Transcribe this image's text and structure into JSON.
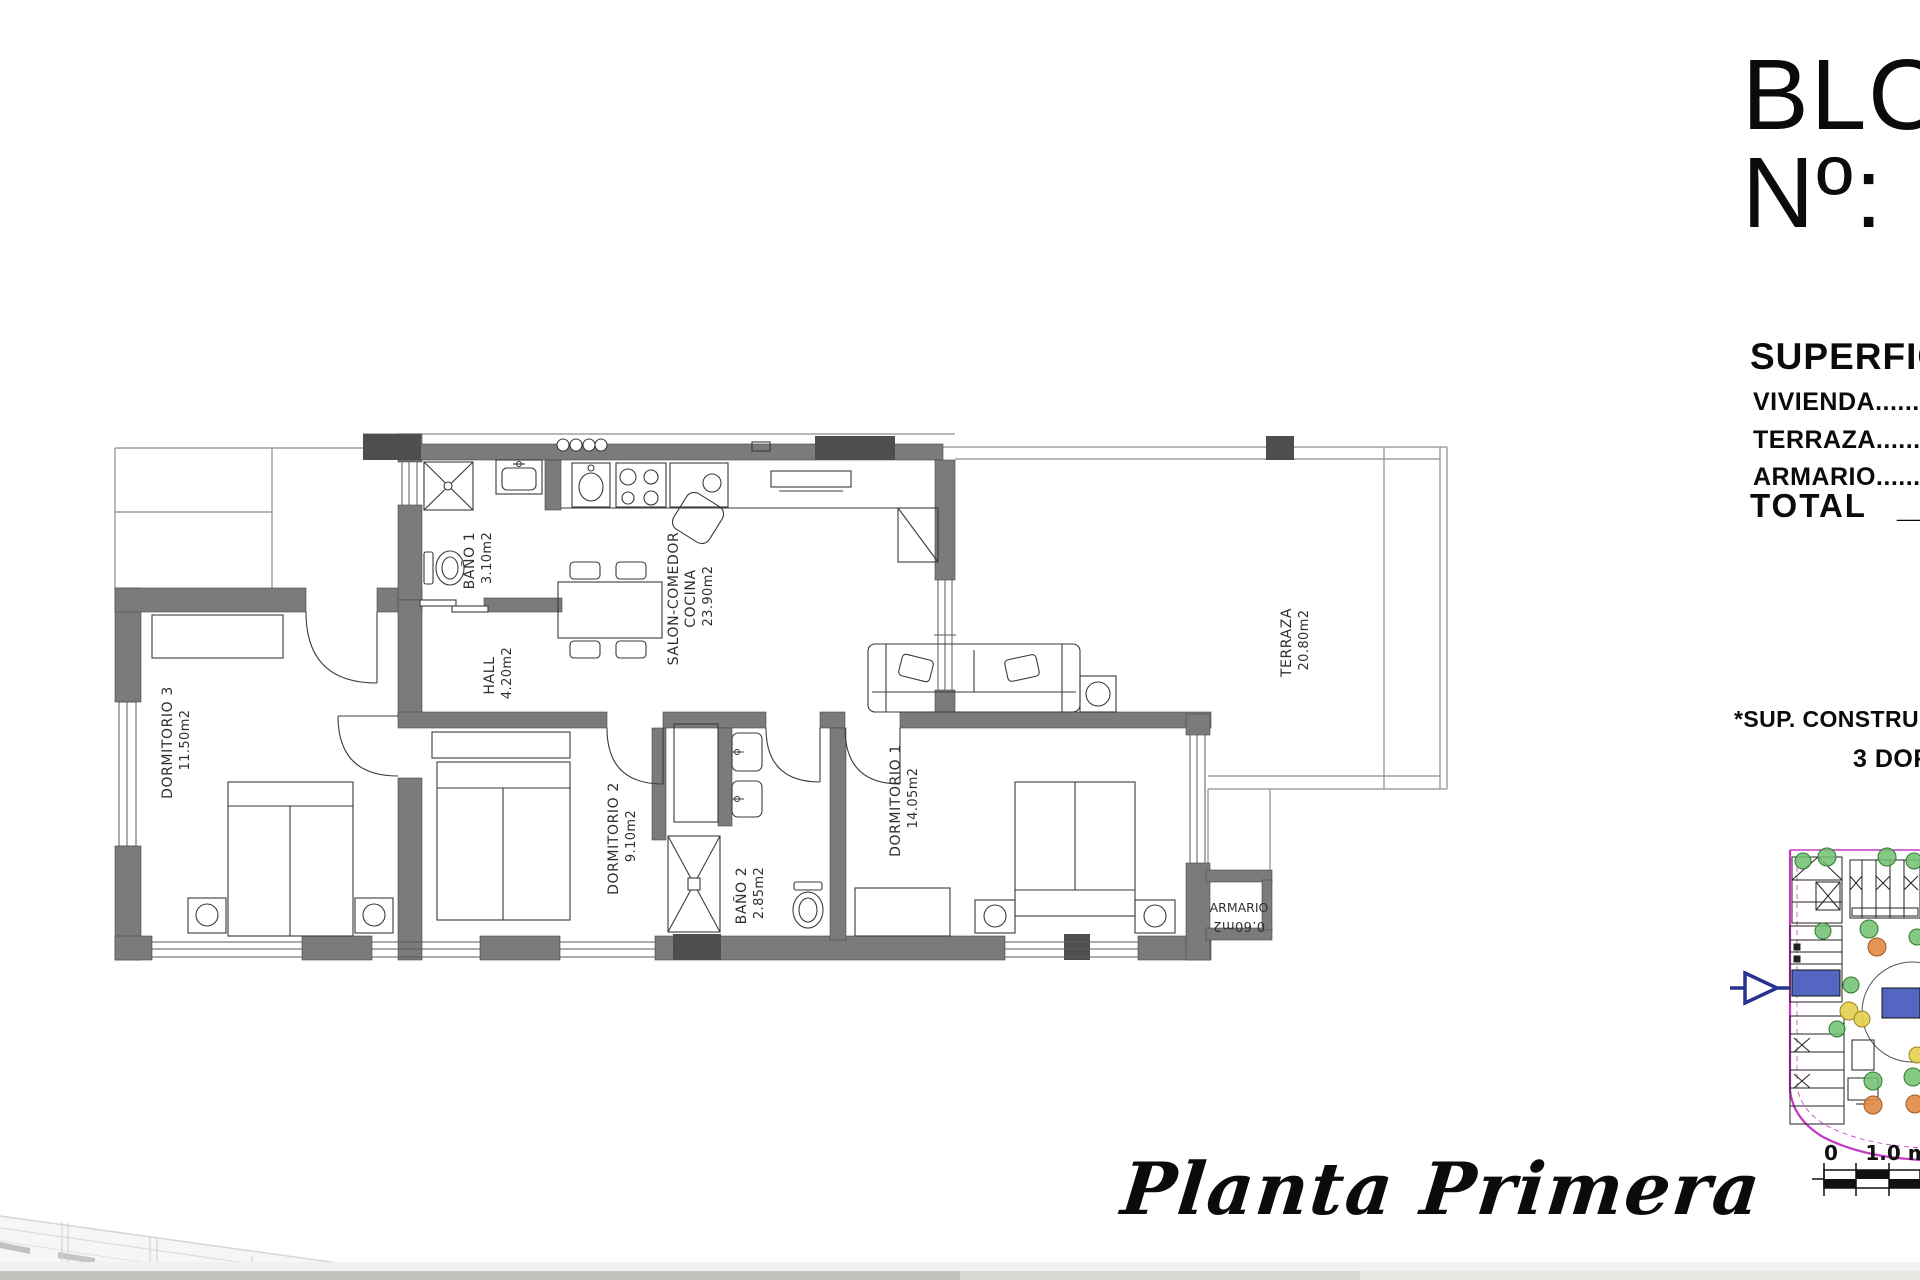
{
  "header": {
    "block_title": "BLOQUE",
    "number_label": "Nº:"
  },
  "surface_panel": {
    "heading": "SUPERFICIE",
    "rows": [
      {
        "text": "VIVIENDA.............."
      },
      {
        "text": "TERRAZA.............."
      },
      {
        "text": "ARMARIO.............."
      }
    ],
    "total_label": "TOTAL",
    "total_placeholder": "__"
  },
  "notes": {
    "construida": "*SUP. CONSTRUIDA",
    "bedrooms": "3 DORMITORIOS"
  },
  "plan": {
    "title_script": "Planta Primera",
    "rooms": [
      {
        "id": "dormitorio-3",
        "name": "DORMITORIO 3",
        "area": "11.50m2"
      },
      {
        "id": "bano-1",
        "name": "BAÑO 1",
        "area": "3.10m2"
      },
      {
        "id": "hall",
        "name": "HALL",
        "area": "4.20m2"
      },
      {
        "id": "salon",
        "name": "SALON-COMEDOR",
        "name2": "COCINA",
        "area": "23.90m2"
      },
      {
        "id": "dormitorio-2",
        "name": "DORMITORIO 2",
        "area": "9.10m2"
      },
      {
        "id": "bano-2",
        "name": "BAÑO 2",
        "area": "2.85m2"
      },
      {
        "id": "dormitorio-1",
        "name": "DORMITORIO 1",
        "area": "14.05m2"
      },
      {
        "id": "armario",
        "name": "ARMARIO",
        "area": "0.60m2"
      },
      {
        "id": "terraza",
        "name": "TERRAZA",
        "area": "20.80m2"
      }
    ]
  },
  "site_map": {
    "scale_zero": "0",
    "scale_one": "1.0 m"
  },
  "colors": {
    "wall_gray": "#7b7b7b",
    "pillar_dark": "#4e4e4e",
    "boundary_magenta": "#c538c5",
    "highlight_blue": "#5266c2",
    "arrow_blue": "#27338f",
    "tree_green": "#4ca64c",
    "bush_yellow": "#e3cf4e",
    "bush_orange": "#df8a45"
  }
}
